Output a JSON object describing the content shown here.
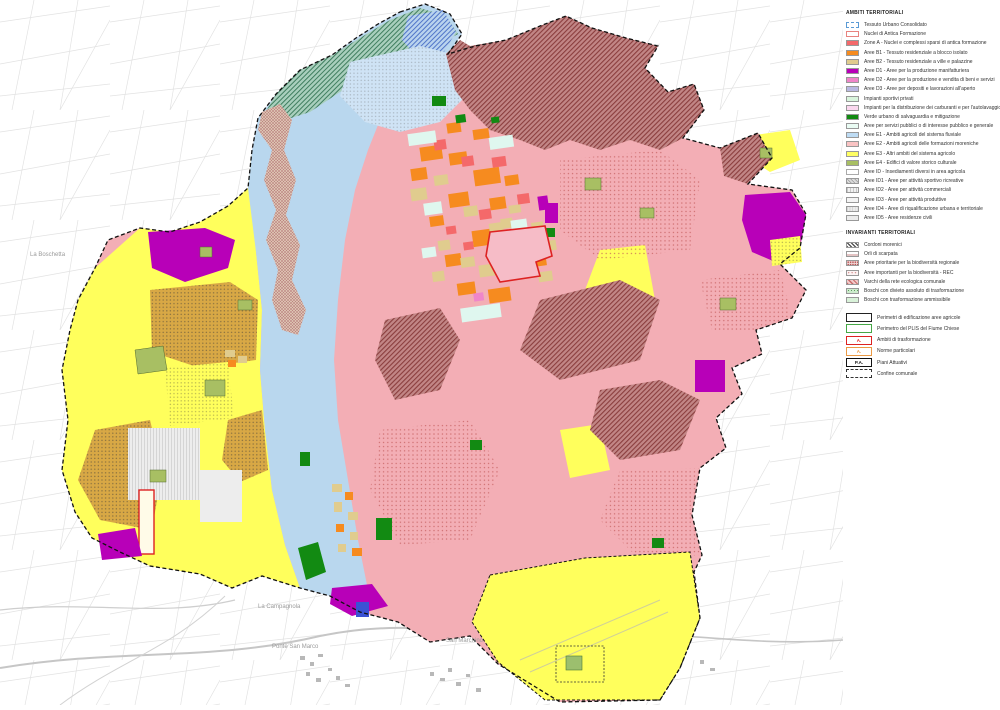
{
  "legend": {
    "section_ambiti_title": "AMBITI TERRITORIALI",
    "ambiti": [
      {
        "label": "Tessuto Urbano Consolidato"
      },
      {
        "label": "Nuclei di Antica Formazione"
      },
      {
        "label": "Zone A - Nuclei e complessi sparsi di antica formazione"
      },
      {
        "label": "Aree B1 - Tessuto residenziale a blocco isolato"
      },
      {
        "label": "Aree B2 - Tessuto residenziale a ville e palazzine"
      },
      {
        "label": "Aree D1 - Aree per la produzione manifatturiera"
      },
      {
        "label": "Aree D2 - Aree per la produzione e vendita di beni e servizi"
      },
      {
        "label": "Aree D3 - Aree per depositi e lavorazioni all'aperto"
      },
      {
        "label": "Impianti sportivi privati"
      },
      {
        "label": "Impianti per la distribuzione dei carburanti e per l'autolavaggio"
      },
      {
        "label": "Verde urbano di salvaguardia e mitigazione"
      },
      {
        "label": "Aree per servizi pubblici o di interesse pubblico e generale"
      },
      {
        "label": "Aree E1 - Ambiti agricoli del sistema fluviale"
      },
      {
        "label": "Aree E2 - Ambiti agricoli delle formazioni moreniche"
      },
      {
        "label": "Aree E3 - Altri ambiti del sistema agricolo"
      },
      {
        "label": "Aree E4 - Edifici di valore storico culturale"
      },
      {
        "label": "Aree ID - Insediamenti diversi in area agricola"
      },
      {
        "label": "Aree ID1 - Aree per attività sportivo ricreative"
      },
      {
        "label": "Aree ID2 - Aree per attività commerciali"
      },
      {
        "label": "Aree ID3 - Aree per attività produttive"
      },
      {
        "label": "Aree ID4 - Aree di riqualificazione urbana e territoriale"
      },
      {
        "label": "Aree ID5 - Aree residenze civili"
      }
    ],
    "section_invarianti_title": "INVARIANTI TERRITORIALI",
    "invarianti": [
      {
        "label": "Cordoni morenici"
      },
      {
        "label": "Orli di scarpata"
      },
      {
        "label": "Aree prioritarie per la biodiversità regionale"
      },
      {
        "label": "Aree importanti per la biodiversità - REC"
      },
      {
        "label": "Varchi della rete ecologica comunale"
      },
      {
        "label": "Boschi con divieto assoluto di trasformazione"
      },
      {
        "label": "Boschi con trasformazione ammissibile"
      }
    ],
    "perimetri": [
      {
        "label": "Perimetri di edificazione aree agricole",
        "inner": ""
      },
      {
        "label": "Perimetro del PLIS del Fiume Chiese",
        "inner": ""
      },
      {
        "label": "Ambiti di trasformazione",
        "inner": "A."
      },
      {
        "label": "Norme particolari",
        "inner": "A."
      },
      {
        "label": "Piani Attuativi",
        "inner": "P.A."
      },
      {
        "label": "Confine comunale",
        "inner": ""
      }
    ]
  },
  "map": {
    "labels": [
      {
        "text": "La Boschetta"
      },
      {
        "text": "La Campagnola"
      },
      {
        "text": "Ponte San Marco"
      },
      {
        "text": "San Marchino"
      }
    ],
    "palette": {
      "zone_a_red": "#f4696a",
      "b1_orange": "#f68b1f",
      "b2_tan": "#e0cc8e",
      "d1_magenta": "#b800b8",
      "d2_pink": "#ef86c9",
      "d3_lavender": "#b9b9e2",
      "verde_green": "#128a12",
      "e1_blue": "#bedcf4",
      "e2_pink": "#f3aeb5",
      "e3_yellow": "#ffff63",
      "e4_olive": "#a8bf63",
      "cordoni_darkred": "#a05252",
      "boundary_black": "#111111",
      "cadastral_gray": "#dedede",
      "at_red_outline": "#dd2222"
    }
  }
}
